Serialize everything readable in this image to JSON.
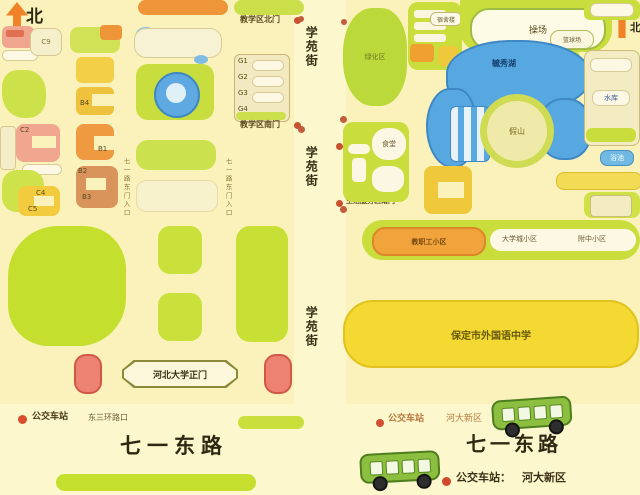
{
  "north": "北",
  "colors": {
    "background": "#FAF2BA",
    "map_green": "#C9DE3C",
    "lake_blue": "#57A7E1",
    "accent_orange": "#F09539",
    "gate_coral": "#ED8172",
    "school_yellow": "#F3D931",
    "legend_red": "#D04828"
  },
  "streets": {
    "vertical": "学苑街",
    "bottom_left": "七一东路",
    "bottom_right": "七一东路"
  },
  "left_map": {
    "gate_north": "教学区北门",
    "gate_south": "教学区南门",
    "main_gate": "河北大学正门",
    "entry_note": "七一路东门入口",
    "buildings": {
      "c9": "C9",
      "c2": "C2",
      "c4": "C4",
      "c5": "C5",
      "b1": "B1",
      "b2": "B2",
      "b3": "B3",
      "b4": "B4",
      "g1": "G1",
      "g2": "G2",
      "g3": "G3",
      "g4": "G4"
    },
    "legend": {
      "label": "公交车站",
      "stop": "东三环路口"
    }
  },
  "right_map": {
    "green_area": "绿化区",
    "dorm": "宿舍楼",
    "playground": "操场",
    "court": "篮球场",
    "lake": "毓秀湖",
    "island": "假山",
    "reservoir": "水库",
    "bath": "浴池",
    "canteen": "食堂",
    "gate_north": "生活服务区北门",
    "gate_south": "生活服务区南门",
    "community_orange": "教职工小区",
    "community_a": "大学城小区",
    "community_b": "附中小区",
    "school": "保定市外国语中学",
    "legend_top": {
      "label": "公交车站",
      "stop": "河大新区"
    },
    "legend_bottom": {
      "label": "公交车站：",
      "stop": "河大新区"
    }
  }
}
